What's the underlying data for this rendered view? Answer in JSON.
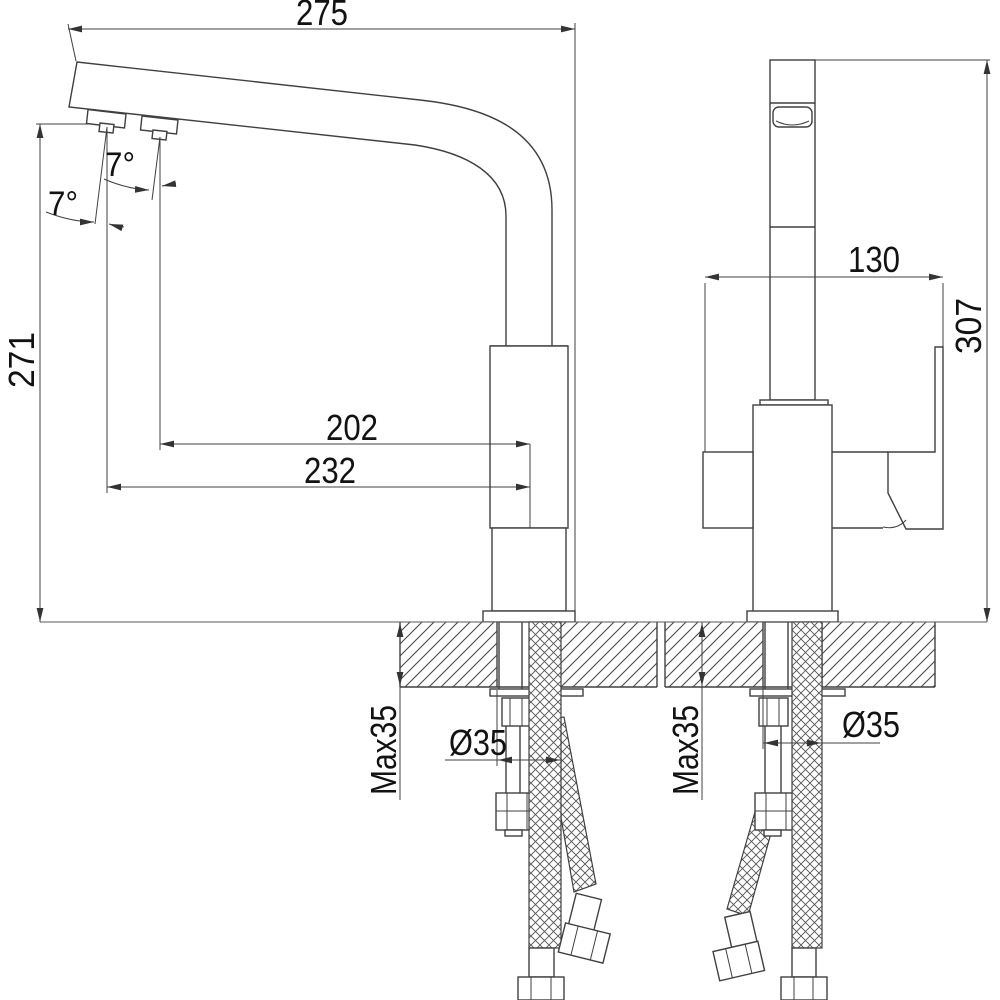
{
  "drawing": {
    "kind": "faucet-installation-dimension-drawing",
    "colors": {
      "line": "#404040",
      "text": "#121212",
      "background": "#ffffff"
    },
    "views": {
      "side": {
        "dims": {
          "spout_length": "275",
          "overall_height": "271",
          "reach_inner": "202",
          "reach_outer": "232",
          "nozzle_angle_front": "7°",
          "nozzle_angle_rear": "7°",
          "counter_thickness_max": "Max35",
          "hole_diameter": "Ø35"
        }
      },
      "front": {
        "dims": {
          "body_depth": "130",
          "overall_height": "307",
          "counter_thickness_max": "Max35",
          "hole_diameter": "Ø35"
        }
      }
    }
  }
}
